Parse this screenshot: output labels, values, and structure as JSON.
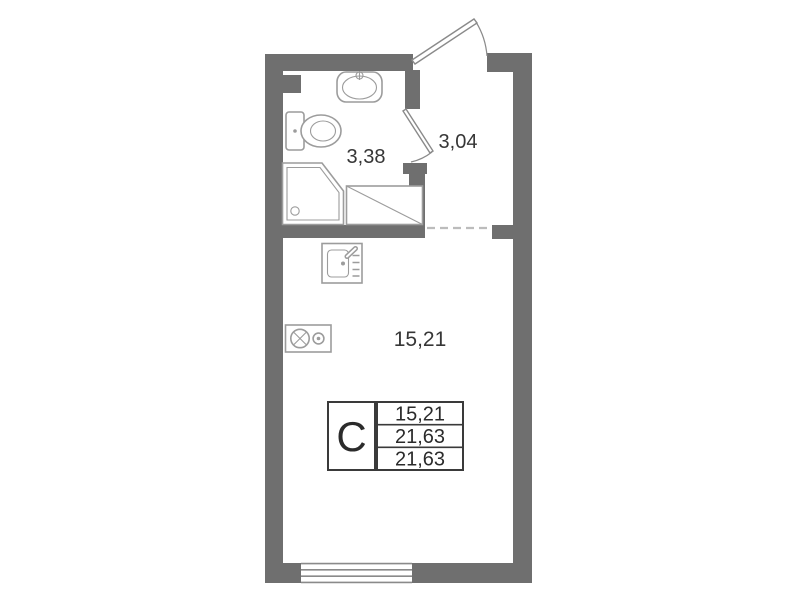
{
  "rooms": {
    "bathroom": {
      "area": "3,38"
    },
    "hall": {
      "area": "3,04"
    },
    "living": {
      "area": "15,21"
    }
  },
  "stamp": {
    "unit_type": "C",
    "rows": [
      "15,21",
      "21,63",
      "21,63"
    ]
  },
  "icons": {
    "washbasin": "washbasin-icon",
    "toilet": "toilet-icon",
    "shower_tray": "shower-tray-icon",
    "counter": "hatched-counter-icon",
    "kitchen_sink": "kitchen-sink-icon",
    "stove": "stove-icon",
    "vent_shaft": "vent-shaft",
    "entry_door": "entry-door-swing",
    "bathroom_door": "bathroom-door-swing",
    "window": "window"
  },
  "colors": {
    "wall": "#6f6f6f",
    "fixture": "#9c9c9c",
    "door": "#8a8a8a",
    "window_line": "#8a8a8a",
    "dashed": "#bcbcbc",
    "text": "#363636",
    "stamp_border": "#3a3a3a",
    "stamp_text": "#2b2b2b"
  }
}
